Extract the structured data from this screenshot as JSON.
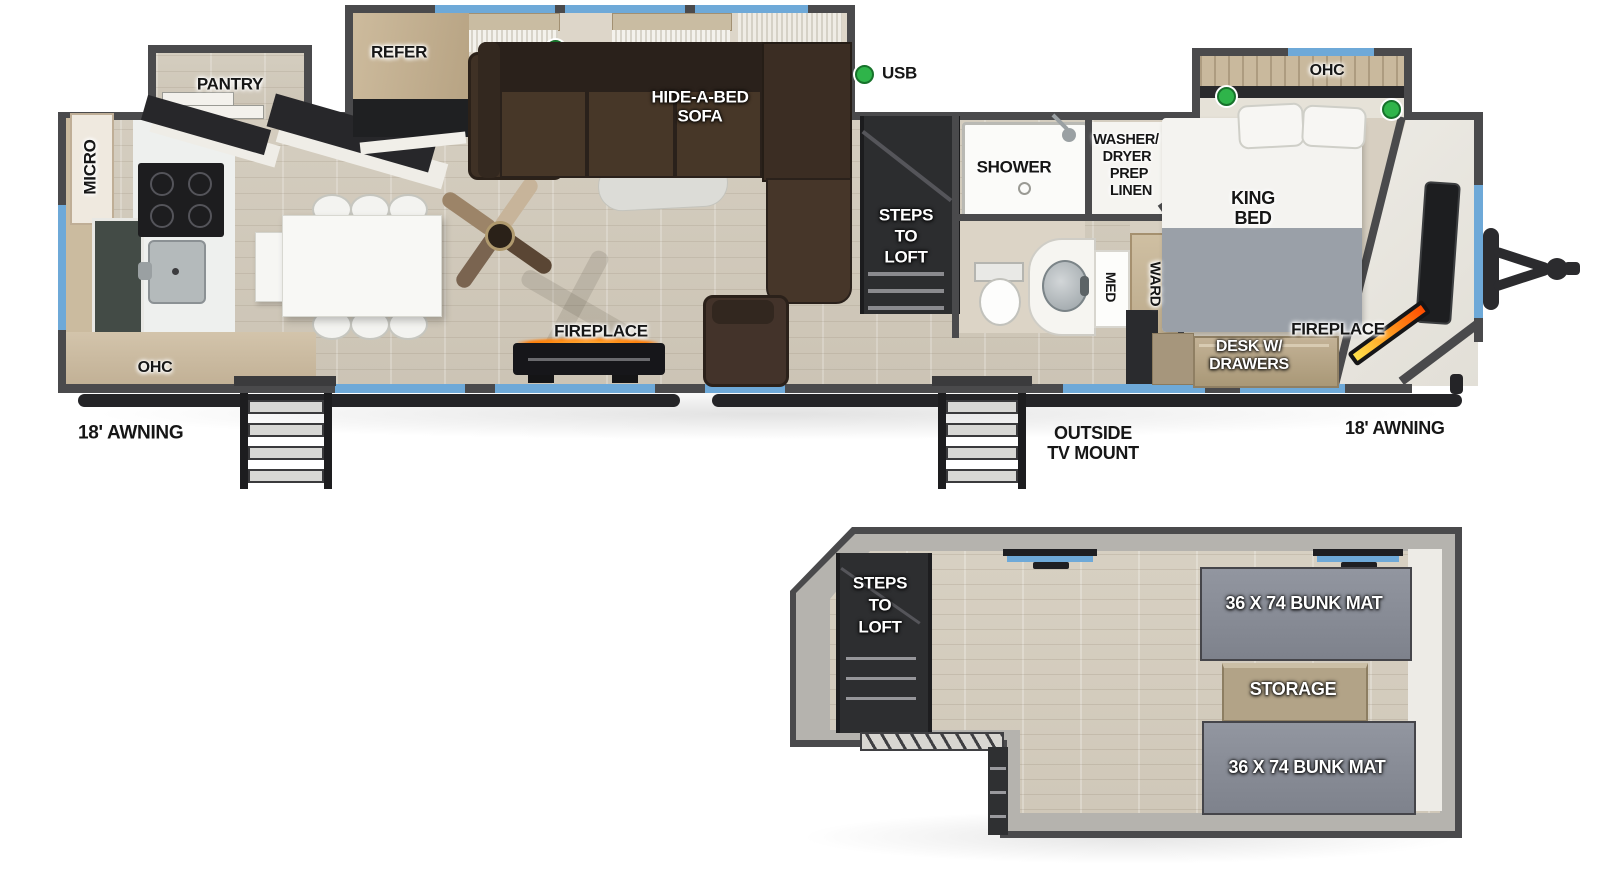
{
  "main_floor": {
    "kitchen": {
      "micro": "MICRO",
      "pantry": "PANTRY",
      "refer": "REFER",
      "ohc": "OHC"
    },
    "living": {
      "hide_a_bed_line1": "HIDE-A-BED",
      "hide_a_bed_line2": "SOFA",
      "fireplace": "FIREPLACE",
      "usb": "USB"
    },
    "loft_steps": {
      "line1": "STEPS",
      "line2": "TO",
      "line3": "LOFT"
    },
    "bath": {
      "shower": "SHOWER",
      "washer_line1": "WASHER/",
      "washer_line2": "DRYER",
      "washer_line3": "PREP",
      "washer_line4": "LINEN",
      "med": "MED",
      "ward": "WARD"
    },
    "bedroom": {
      "ohc": "OHC",
      "king_line1": "KING",
      "king_line2": "BED",
      "desk_line1": "DESK W/",
      "desk_line2": "DRAWERS",
      "fireplace": "FIREPLACE"
    },
    "exterior": {
      "awning_left": "18' AWNING",
      "awning_right": "18' AWNING",
      "tv_mount_line1": "OUTSIDE",
      "tv_mount_line2": "TV MOUNT"
    }
  },
  "loft_floor": {
    "steps_line1": "STEPS",
    "steps_line2": "TO",
    "steps_line3": "LOFT",
    "bunk_top": "36 X 74 BUNK MAT",
    "storage": "STORAGE",
    "bunk_bottom": "36 X 74 BUNK MAT"
  },
  "colors": {
    "wall": "#4a4a4c",
    "window_accent": "#6ea9d8",
    "usb_indicator": "#2fb44a",
    "flame": "#ff8a00",
    "wood_floor": "#d2cabc",
    "bunk_mat": "#878b93",
    "sofa_brown": "#40332a",
    "cabinet_wood": "#c4b296"
  }
}
